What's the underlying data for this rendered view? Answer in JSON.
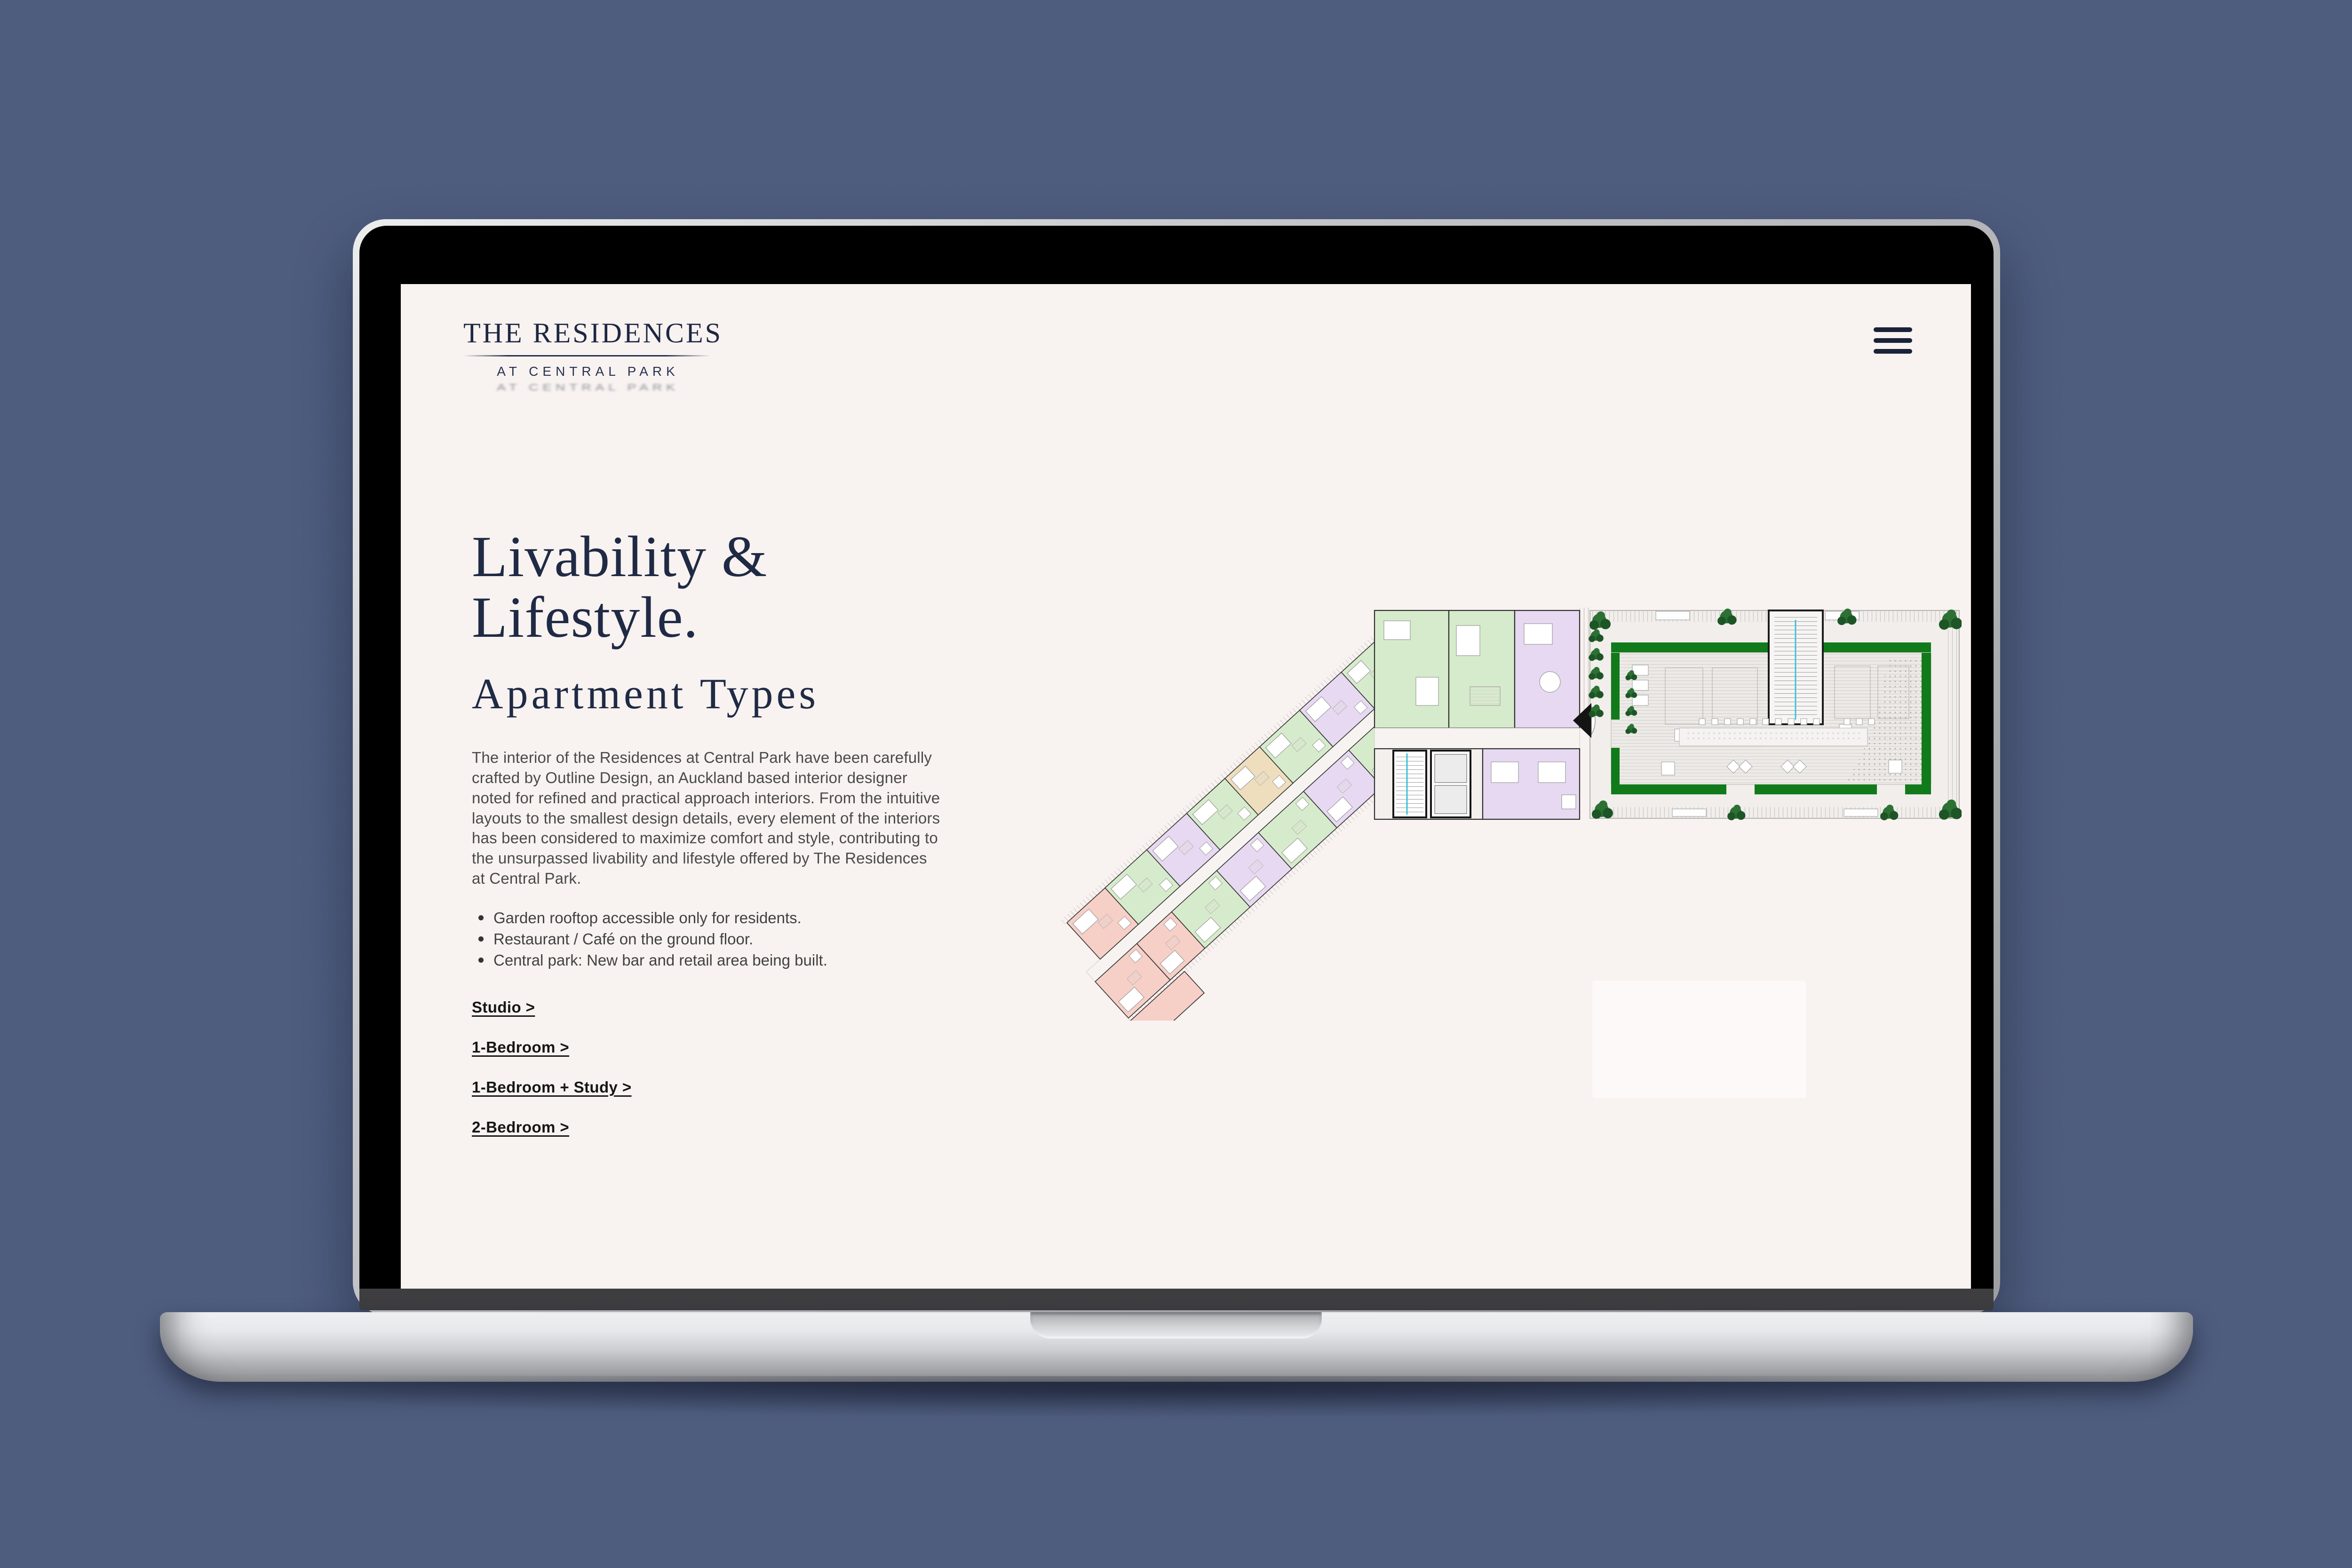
{
  "site": {
    "logo": {
      "title": "THE RESIDENCES",
      "subtitle": "AT CENTRAL PARK",
      "color": "#1d2742"
    },
    "nav": {
      "menu_icon": "hamburger-icon"
    },
    "hero": {
      "heading_line1": "Livability &",
      "heading_line2": "Lifestyle.",
      "subheading": "Apartment Types",
      "paragraph": "The interior of the Residences at Central Park have been carefully crafted by Outline Design, an Auckland based interior designer noted for refined and practical approach interiors. From the intuitive layouts to the smallest design details, every element of the interiors has been considered to maximize comfort and style, contributing to the unsurpassed livability and lifestyle offered by The Residences at Central Park.",
      "bullets": [
        "Garden rooftop accessible only for residents.",
        "Restaurant / Café on the ground floor.",
        "Central park: New bar and retail area being built."
      ],
      "links": [
        {
          "label": "Studio >"
        },
        {
          "label": "1-Bedroom >"
        },
        {
          "label": "1-Bedroom + Study >"
        },
        {
          "label": "2-Bedroom >"
        }
      ]
    },
    "floor_plan": {
      "description": "Floor plan with colored apartment units, central lift core and rooftop garden terrace",
      "colors": {
        "unit_green": "#d6ebcb",
        "unit_purple": "#e7d9f1",
        "unit_pink": "#f6cfc7",
        "unit_beige": "#eedebe",
        "hedge_green": "#117a1b",
        "bush_green": "#2c7133",
        "bush_dark": "#1d5526",
        "wall": "#2e2e2e",
        "deck": "#edebe8",
        "stair_cyan": "#39c2d8"
      },
      "wing": {
        "angle_deg": -42.4,
        "top_row": [
          {
            "w": 110,
            "c": "pink"
          },
          {
            "w": 120,
            "c": "green"
          },
          {
            "w": 115,
            "c": "purple"
          },
          {
            "w": 110,
            "c": "green"
          },
          {
            "w": 100,
            "c": "beige"
          },
          {
            "w": 115,
            "c": "green"
          },
          {
            "w": 120,
            "c": "purple"
          },
          {
            "w": 95,
            "c": "green"
          }
        ],
        "bottom_row": [
          {
            "w": 120,
            "c": "pink"
          },
          {
            "w": 100,
            "c": "pink"
          },
          {
            "w": 130,
            "c": "green"
          },
          {
            "w": 120,
            "c": "purple"
          },
          {
            "w": 130,
            "c": "green"
          },
          {
            "w": 130,
            "c": "purple"
          },
          {
            "w": 110,
            "c": "green"
          }
        ]
      }
    },
    "page_background": "#4d5b7d",
    "screen_background": "#f8f2f0"
  }
}
